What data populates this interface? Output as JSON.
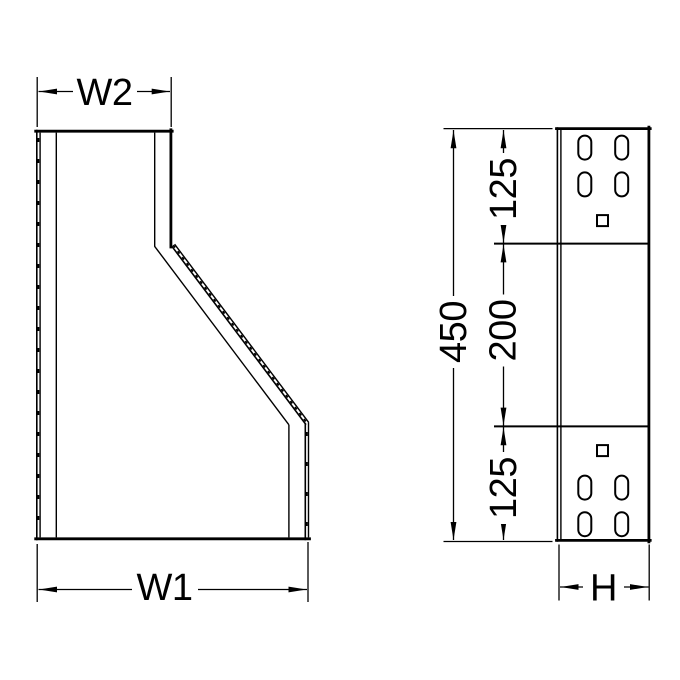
{
  "colors": {
    "background": "#ffffff",
    "line": "#000000"
  },
  "drawing": {
    "labels": {
      "w2": "W2",
      "w1": "W1",
      "h": "H",
      "total_height": "450",
      "seg_top": "125",
      "seg_mid": "200",
      "seg_bot": "125"
    }
  }
}
